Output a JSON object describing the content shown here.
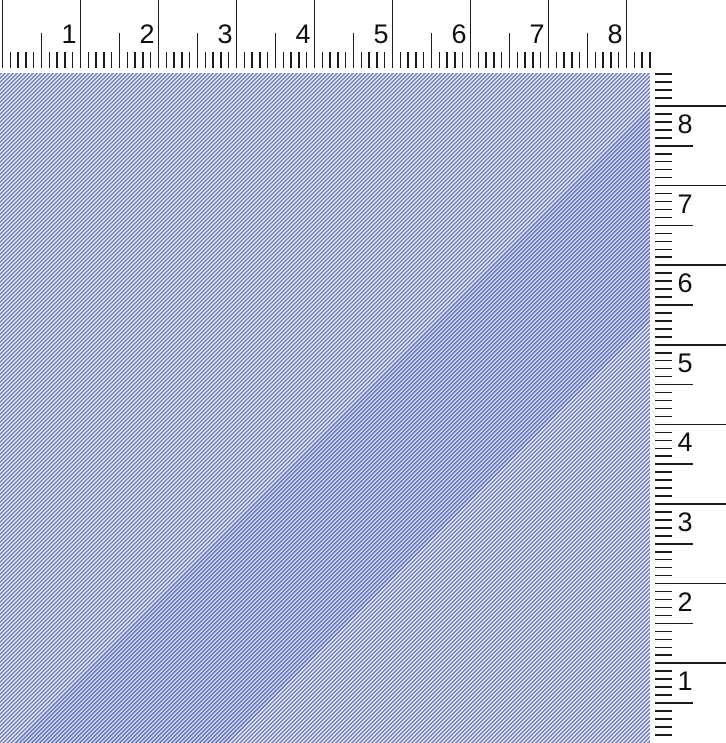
{
  "rulers": {
    "background_color": "#ffffff",
    "tick_color": "#1b1b1b",
    "number_color": "#0e0e0e",
    "subdivisions_per_unit": 10,
    "top": {
      "orientation": "horizontal",
      "labels": [
        "1",
        "2",
        "3",
        "4",
        "5",
        "6",
        "7",
        "8"
      ]
    },
    "right": {
      "orientation": "vertical",
      "labels": [
        "8",
        "7",
        "6",
        "5",
        "4",
        "3",
        "2",
        "1"
      ]
    }
  },
  "canvas_pattern": {
    "stripe_color": "#6b7bbd",
    "gap_color": "#eceefa",
    "stripe_direction": "diagonal-up-right",
    "horizontal_period_px": 4
  }
}
